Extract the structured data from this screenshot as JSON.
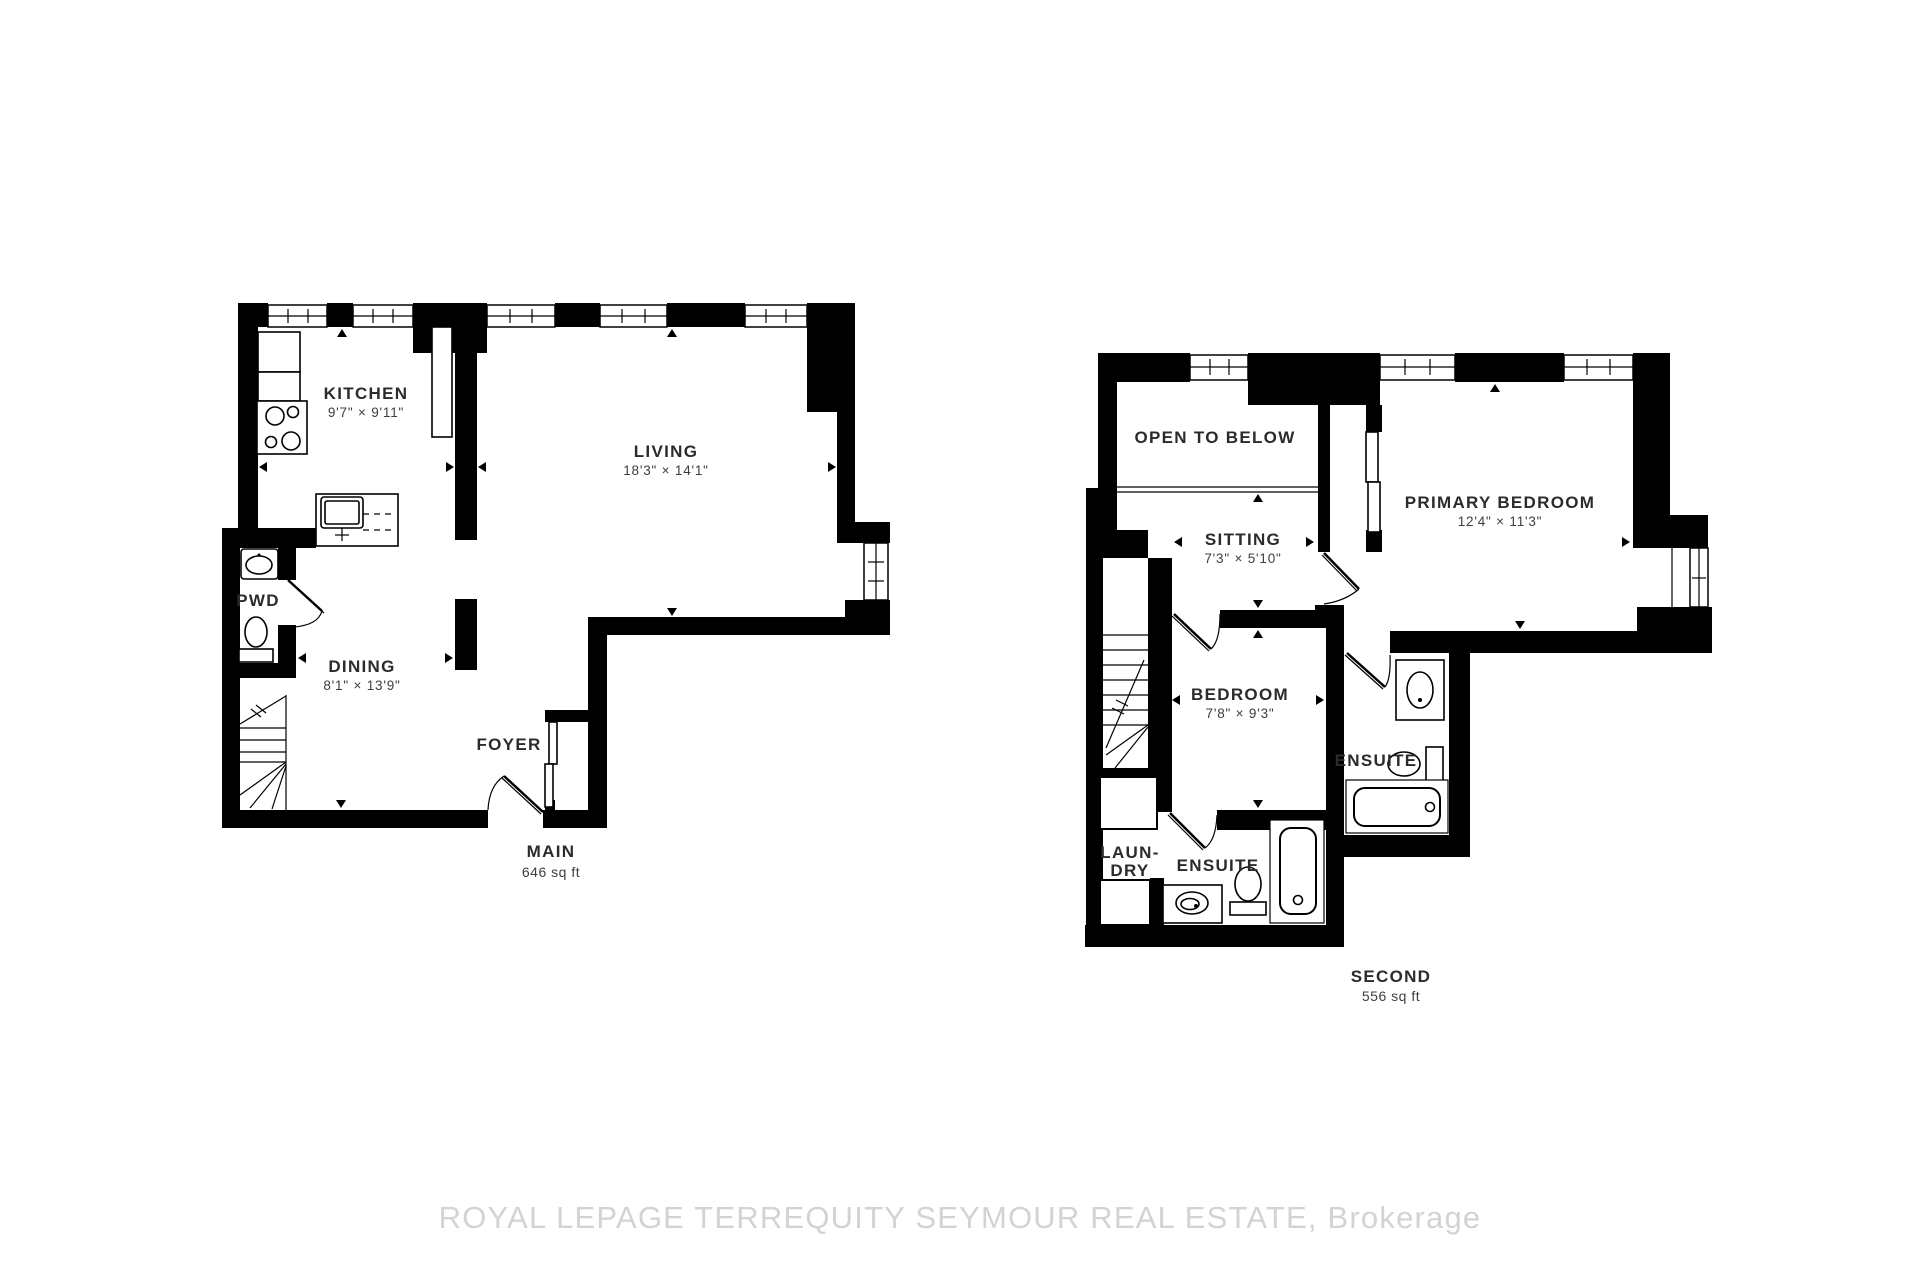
{
  "watermark": "ROYAL LEPAGE TERREQUITY SEYMOUR REAL ESTATE, Brokerage",
  "floors": {
    "main": {
      "title": "MAIN",
      "area": "646 sq ft",
      "rooms": {
        "kitchen": {
          "name": "KITCHEN",
          "dims": "9'7\" × 9'11\""
        },
        "living": {
          "name": "LIVING",
          "dims": "18'3\" × 14'1\""
        },
        "dining": {
          "name": "DINING",
          "dims": "8'1\" × 13'9\""
        },
        "powder": {
          "name": "PWD"
        },
        "foyer": {
          "name": "FOYER"
        }
      }
    },
    "second": {
      "title": "SECOND",
      "area": "556 sq ft",
      "rooms": {
        "open_to_below": {
          "name": "OPEN TO BELOW"
        },
        "sitting": {
          "name": "SITTING",
          "dims": "7'3\" × 5'10\""
        },
        "primary_bedroom": {
          "name": "PRIMARY BEDROOM",
          "dims": "12'4\" × 11'3\""
        },
        "bedroom": {
          "name": "BEDROOM",
          "dims": "7'8\" × 9'3\""
        },
        "primary_ensuite": {
          "name": "ENSUITE"
        },
        "bedroom_ensuite": {
          "name": "ENSUITE"
        },
        "laundry": {
          "line1": "LAUN-",
          "line2": "DRY"
        }
      }
    }
  }
}
